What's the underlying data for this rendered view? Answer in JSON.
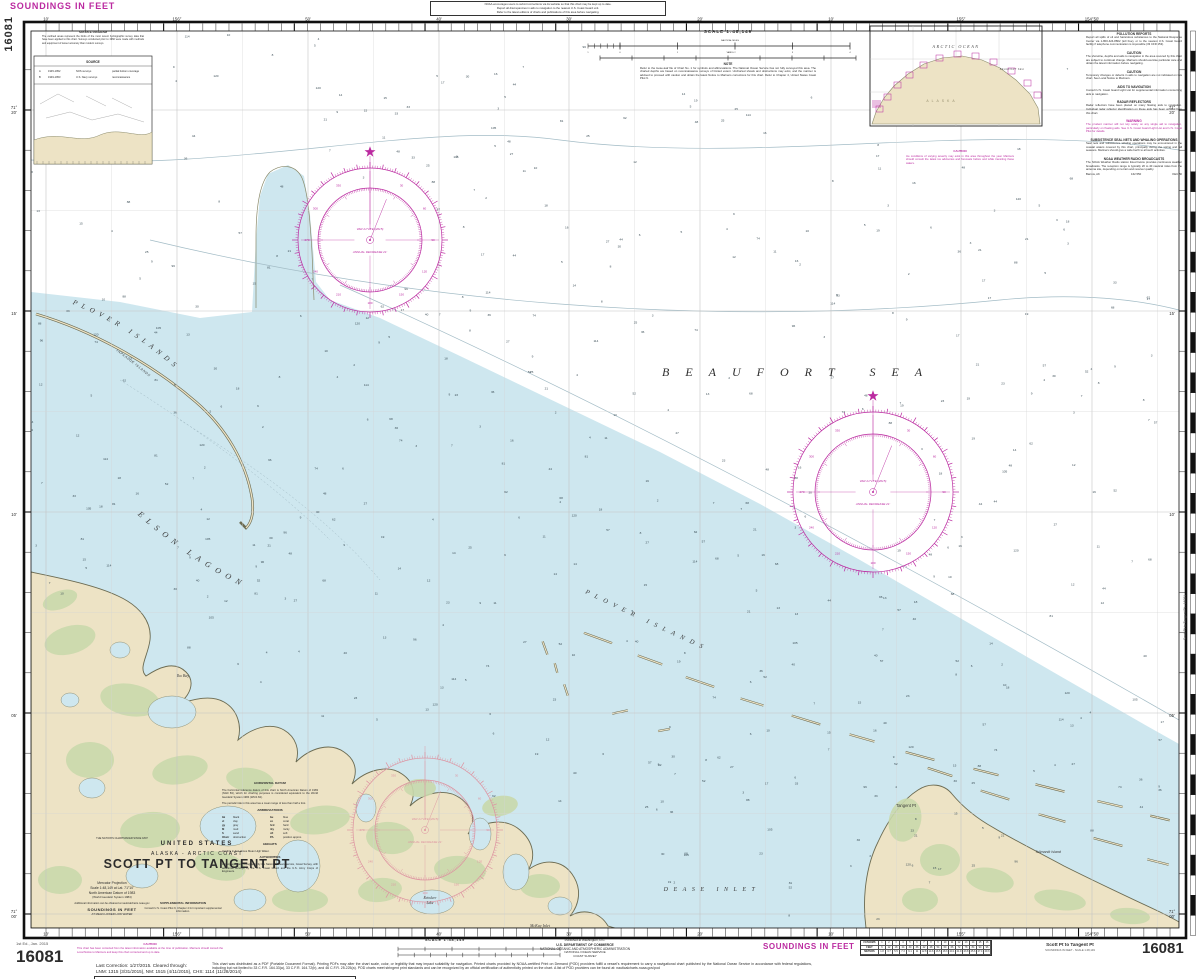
{
  "palette": {
    "water": "#cee7ef",
    "land": "#ede3c5",
    "green": "#c9d8ab",
    "shore": "#6b6b52",
    "magenta": "#bb2aa0",
    "pale_rose": "#dd92a0",
    "graticule": "#c4c4c4",
    "contour": "#a3bcc6",
    "ink": "#2b2b2b",
    "frame": "#101010",
    "sounding": "#3c4e57"
  },
  "chart_no": "16081",
  "margin_top": {
    "soundings": "SOUNDINGS IN FEET",
    "note_lines": [
      "NOAA encourages users to submit corrections via its website so that this chart may be kept up to date.",
      "Report all discrepancies in aids to navigation to the nearest U.S. Coast Guard unit.",
      "Refer to the latest editions of charts and publications of this area before navigating."
    ]
  },
  "graticule": {
    "lon_labels": [
      {
        "t": "10'",
        "x": 46
      },
      {
        "t": "156°",
        "x": 177
      },
      {
        "t": "50'",
        "x": 308
      },
      {
        "t": "40'",
        "x": 439
      },
      {
        "t": "30'",
        "x": 569
      },
      {
        "t": "20'",
        "x": 700
      },
      {
        "t": "10'",
        "x": 831
      },
      {
        "t": "155°",
        "x": 961
      },
      {
        "t": "154°50'",
        "x": 1092
      }
    ],
    "lat_labels": [
      {
        "deg": "71°",
        "min": "20'",
        "y": 110
      },
      {
        "deg": "",
        "min": "15'",
        "y": 311
      },
      {
        "deg": "",
        "min": "10'",
        "y": 512
      },
      {
        "deg": "",
        "min": "05'",
        "y": 713
      },
      {
        "deg": "71°",
        "min": "00'",
        "y": 914
      }
    ]
  },
  "top_scale": {
    "scale": "SCALE 1:48,149",
    "nm": "NAUTICAL MILES",
    "yd": "YARDS",
    "note_h": "NOTE",
    "note": "Refer to the loose-leaf file of Chart No. 1 for symbols and abbreviations. The National Ocean Service has not fully surveyed this area. The charted depths are based on reconnaissance surveys of limited extent. Uncharted shoals and obstructions may exist, and the mariner is advised to proceed with caution and obtain the latest Notice to Mariners corrections for this chart. Refer to Chapter 4, United States Coast Pilot 9."
  },
  "labels": {
    "places": [
      {
        "n": "beaufort-sea",
        "t": "BEAUFORT SEA",
        "x": 662,
        "y": 376,
        "fs": 12,
        "sp": 16,
        "it": 1,
        "ser": 1,
        "an": "start",
        "fill": "#2f2f2f"
      },
      {
        "n": "dease-inlet",
        "t": "DEASE INLET",
        "x": 712,
        "y": 891,
        "fs": 6,
        "sp": 5.5,
        "it": 1,
        "ser": 1
      },
      {
        "n": "iko-bay",
        "t": "Iko Bay",
        "x": 183,
        "y": 677,
        "fs": 4,
        "it": 1,
        "ser": 1
      },
      {
        "n": "reindeer-lake",
        "t": "Reindeer",
        "x": 430,
        "y": 899,
        "fs": 3.6,
        "it": 1,
        "ser": 1
      },
      {
        "n": "reindeer-lake",
        "t": "Lake",
        "x": 430,
        "y": 904,
        "fs": 3.6,
        "it": 1,
        "ser": 1
      },
      {
        "n": "mckay-inlet",
        "t": "McKay Inlet",
        "x": 540,
        "y": 927,
        "fs": 4,
        "it": 1,
        "ser": 1
      },
      {
        "n": "tangent-pt",
        "t": "Tangent Pt",
        "x": 906,
        "y": 807,
        "fs": 4.2
      },
      {
        "n": "tulimanik-island",
        "t": "Tulimanik Island",
        "x": 1048,
        "y": 853,
        "fs": 3.6,
        "it": 1
      }
    ],
    "arcs": [
      {
        "n": "plover-islands-nw",
        "path": "ap1",
        "t": "PLOVER   ISLANDS",
        "fs": 7,
        "sp": 5,
        "it": 1,
        "ser": 1
      },
      {
        "n": "elson-lagoon",
        "path": "ap2",
        "t": "ELSON   LAGOON",
        "fs": 8,
        "sp": 6,
        "it": 1,
        "ser": 1
      },
      {
        "n": "plover-islands-se",
        "path": "ap3",
        "t": "PLOVER  ISLANDS",
        "fs": 6.5,
        "sp": 6,
        "it": 1,
        "ser": 1
      },
      {
        "n": "tapkaluk-islands",
        "path": "ap4",
        "t": "TAPKALUK ISLANDS",
        "fs": 3.4,
        "sp": 0.6,
        "it": 1
      }
    ]
  },
  "compass": {
    "var1": "VAR 21°15'E (2015)",
    "var2": "ANNUAL DECREASE 21'",
    "roses": [
      {
        "cx": 370,
        "cy": 240,
        "ro": 72,
        "ri": 52,
        "pale": false,
        "star": true
      },
      {
        "cx": 873,
        "cy": 492,
        "ro": 80,
        "ri": 58,
        "pale": false,
        "star": true
      },
      {
        "cx": 425,
        "cy": 830,
        "ro": 72,
        "ri": 50,
        "pale": true,
        "star": false
      }
    ]
  },
  "inset": {
    "ocean": "ARCTIC OCEAN",
    "sea": "BEAUFORT SEA",
    "land": "ALASKA"
  },
  "source_diagram": {
    "caption": "SOURCE DIAGRAM",
    "para": "The outlined areas represent the limits of the most recent hydrographic survey data that have been applied to this chart. Surveys conducted prior to 1960 were made with methods and equipment of lesser accuracy than modern surveys.",
    "table_title": "SOURCE",
    "rows": [
      [
        "A",
        "1945-1952",
        "NOS surveys",
        "partial bottom coverage"
      ],
      [
        "B",
        "1949-1953",
        "U.S. Navy surveys",
        "reconnaissance"
      ]
    ]
  },
  "sea_note": {
    "h": "CAUTION",
    "body": "Ice conditions of varying severity may exist in this area throughout the year. Mariners should consult the latest ice advisories and forecasts before and while transiting these waters."
  },
  "right_notes": {
    "sections": [
      {
        "h": "POLLUTION REPORTS",
        "b": "Report all spills of oil and hazardous substances to the National Response Center via 1-800-424-8802 (toll free), or to the nearest U.S. Coast Guard facility if telephone communication is impossible (33 CFR 153)."
      },
      {
        "h": "CAUTION",
        "b": "The shoreline, depths and aids to navigation in the area covered by this chart are subject to continual change. Mariners should exercise particular care and obtain the latest information before navigating."
      },
      {
        "h": "CAUTION",
        "b": "Temporary changes or defects in aids to navigation are not indicated on this chart. See Local Notice to Mariners."
      },
      {
        "h": "AIDS TO NAVIGATION",
        "b": "Consult U.S. Coast Guard Light List for supplemental information concerning aids to navigation."
      },
      {
        "h": "RADAR REFLECTORS",
        "b": "Radar reflectors have been placed on many floating aids to navigation. Individual radar reflector identification on these aids has been omitted from this chart."
      },
      {
        "h": "WARNING",
        "b": "The prudent mariner will not rely solely on any single aid to navigation, particularly on floating aids. See U.S. Coast Guard Light List and U.S. Coast Pilot for details.",
        "magenta": true
      },
      {
        "h": "SUBSISTENCE SEAL NETS AND WHALING OPERATIONS",
        "b": "Seal nets and subsistence whaling operations may be encountered in the coastal waters covered by this chart, principally during the spring and fall seasons. Mariners should give a wide berth to all such activities."
      },
      {
        "h": "NOAA WEATHER RADIO BROADCASTS",
        "b": "The NOAA Weather Radio station listed below provides continuous weather broadcasts. The reception range is typically 20 to 40 nautical miles from the antenna site, depending on terrain and receiver quality.",
        "station": [
          "Barrow, AK",
          "162.550",
          "KEC 80"
        ]
      }
    ]
  },
  "title_block": {
    "tagline": "THE NATION'S CHARTMAKER SINCE 1807",
    "country": "UNITED STATES",
    "region": "ALASKA - ARCTIC COAST",
    "title": "SCOTT PT TO TANGENT PT",
    "proj1": "Mercator Projection",
    "proj2": "Scale 1:48,149 at Lat. 71°10'",
    "proj3": "North American Datum of 1983",
    "proj4": "(World Geodetic System 1984)",
    "info": "Additional information can be obtained at nauticalcharts.noaa.gov",
    "soundings": "SOUNDINGS IN FEET",
    "mllw": "AT MEAN LOWER LOW WATER",
    "supp_h": "SUPPLEMENTAL INFORMATION",
    "supp_b": "Consult U.S. Coast Pilot 9, Chapter 4 for important supplemental information."
  },
  "datum_notes": {
    "hd_h": "HORIZONTAL DATUM",
    "hd_b": "The horizontal reference datum of this chart is North American Datum of 1983 (NAD 83), which for charting purposes is considered equivalent to the World Geodetic System 1984 (WGS 84).",
    "tides": "The periodic tide in this area has a mean range of less than half a foot.",
    "ab_h": "ABBREVIATIONS",
    "abbrev": [
      [
        "bk",
        "black"
      ],
      [
        "bu",
        "blue"
      ],
      [
        "cl",
        "clay"
      ],
      [
        "co",
        "coral"
      ],
      [
        "gy",
        "gray"
      ],
      [
        "hrd",
        "hard"
      ],
      [
        "M",
        "mud"
      ],
      [
        "rky",
        "rocky"
      ],
      [
        "S",
        "sand"
      ],
      [
        "sft",
        "soft"
      ],
      [
        "Obstr",
        "obstruction"
      ],
      [
        "PA",
        "position approx."
      ]
    ],
    "he_h": "HEIGHTS",
    "he_b": "Heights in feet above Mean High Water.",
    "au_h": "AUTHORITIES",
    "au_b": "Hydrography and topography by the National Ocean Service, Coast Survey, with additional surveys by the U.S. Coast Guard and the U.S. Army Corps of Engineers."
  },
  "bottom": {
    "edition": "1st Ed., Jan. 2015",
    "number": "16081",
    "caution_h": "CAUTION",
    "caution_b": "This chart has been corrected from the latest information available at the time of publication. Mariners should consult the Local Notice to Mariners and keep this chart corrected and up to date.",
    "corr1": "Last Correction: 1/27/2015.  Cleared through:",
    "corr2": "LNM: 1315 (3/31/2015), NM: 1515 (4/11/2015), CHS: 1114 (11/28/2014)",
    "scale": "SCALE 1:48,149",
    "pub1": "Published at Washington, D.C.",
    "pub2": "U.S. DEPARTMENT OF COMMERCE",
    "pub3": "NATIONAL OCEANIC AND ATMOSPHERIC ADMINISTRATION",
    "pub4": "NATIONAL OCEAN SERVICE",
    "pub5": "COAST SURVEY",
    "pod": "This chart was distributed as a PDF (Portable Document Format). Printing PDFs may alter the chart scale, color, or legibility that may impact suitability for navigation. Printed charts provided by NOAA-certified Print on Demand (POD) providers fulfill a vessel's requirement to carry a navigational chart published by the National Ocean Service in accordance with federal regulations, including but not limited to 33 C.F.R. 164.33(a), 33 C.F.R. 164.72(b), and 46 C.F.R. 25.225(a). POD charts meet stringent print standards and can be recognized by an official certification of authenticity printed on the chart. A list of POD providers can be found at: nauticalcharts.noaa.gov/pod",
    "soundings": "SOUNDINGS IN FEET",
    "subtitle1": "Scott Pt to Tangent Pt",
    "subtitle2": "SOUNDINGS IN FEET - SCALE 1:48,149",
    "side_label": "Scott Pt to Tangent Pt - 16081",
    "conv": {
      "labels": [
        "FATHOMS",
        "FEET",
        "METERS"
      ],
      "fathoms": [
        "1",
        "2",
        "3",
        "4",
        "5",
        "6",
        "7",
        "8",
        "9",
        "10",
        "11",
        "12",
        "13",
        "14",
        "15",
        "16"
      ],
      "feet": [
        "6",
        "12",
        "18",
        "24",
        "30",
        "36",
        "42",
        "48",
        "54",
        "60",
        "66",
        "72",
        "78",
        "84",
        "90",
        "96"
      ],
      "meters": [
        "1.8",
        "3.7",
        "5.5",
        "7.3",
        "9.1",
        "11",
        "12.8",
        "14.6",
        "16.5",
        "18.3",
        "20.1",
        "21.9",
        "23.8",
        "25.6",
        "27.4",
        "29.3"
      ]
    }
  },
  "soundings_values": [
    "2",
    "3",
    "3",
    "4",
    "4",
    "5",
    "5",
    "6",
    "6",
    "7",
    "7",
    "8",
    "8",
    "9",
    "9",
    "10",
    "11",
    "12",
    "13",
    "14",
    "15",
    "16",
    "17",
    "18",
    "19",
    "21",
    "23",
    "25",
    "27",
    "30",
    "33",
    "36",
    "40",
    "44",
    "48",
    "52",
    "57",
    "62",
    "68",
    "74",
    "81",
    "88",
    "96",
    "105",
    "114",
    "120"
  ]
}
